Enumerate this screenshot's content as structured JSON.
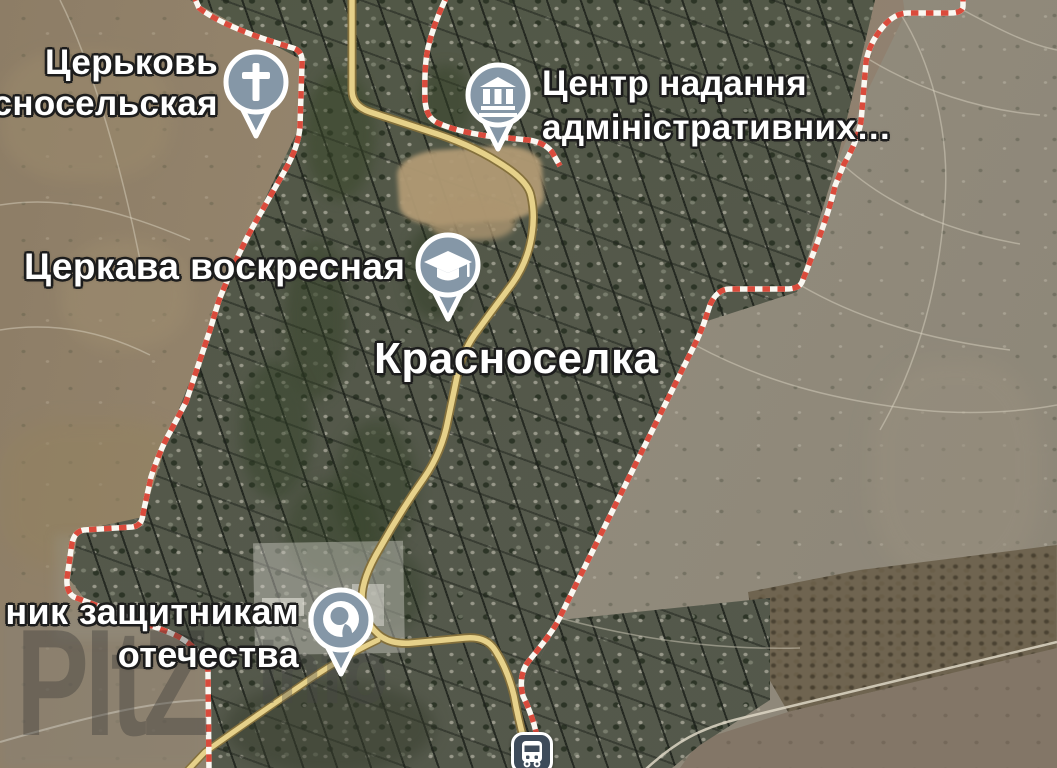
{
  "map": {
    "locality": {
      "name": "Красноселка"
    },
    "pois": [
      {
        "id": "church-krasnoselskaya",
        "label_line1": "Церьковь",
        "label_line2": "сносельская",
        "icon": "church-cross-icon"
      },
      {
        "id": "admin-center",
        "label_line1": "Центр надання",
        "label_line2": "адміністративних…",
        "icon": "government-building-icon"
      },
      {
        "id": "church-voskresnaya",
        "label": "Церкава воскресная",
        "icon": "graduation-cap-icon"
      },
      {
        "id": "monument-defenders",
        "label_line1": "ник защитникам",
        "label_line2": "отечества",
        "icon": "monument-icon"
      },
      {
        "id": "bus-stop",
        "icon": "bus-icon"
      }
    ],
    "watermark": {
      "text_main": "PItZ",
      "text_sub": "Info"
    },
    "colors": {
      "boundary_red": "#da4b3c",
      "boundary_white": "#faf7f1",
      "road_fill": "#e6d18a",
      "road_casing": "#84703c",
      "pin_fill": "#8597a7",
      "pin_border": "#ffffff",
      "bus_icon_bg": "#3e4b5a",
      "town_base": "#585c4f",
      "farm_base": "#8d7d66",
      "open_land": "#8f8879"
    }
  }
}
